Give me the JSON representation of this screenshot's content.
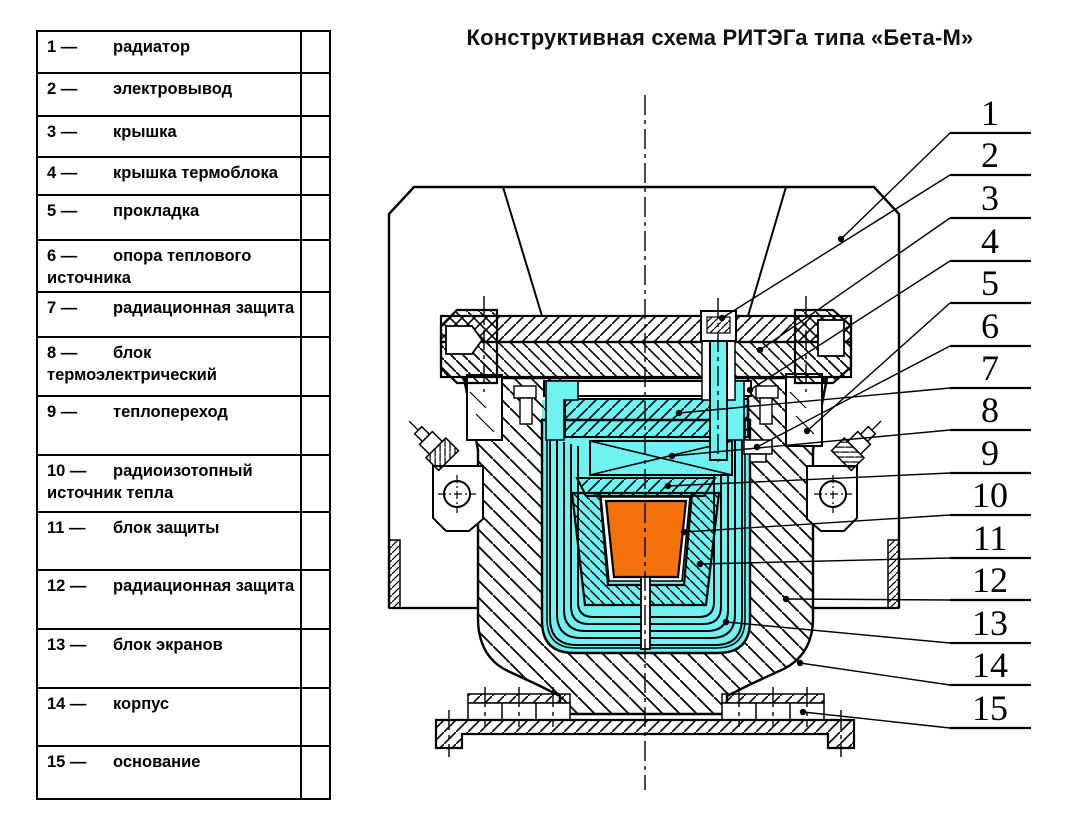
{
  "title": "Конструктивная схема РИТЭГа типа «Бета-М»",
  "legend": {
    "items": [
      {
        "num": "1",
        "name": "радиатор"
      },
      {
        "num": "2",
        "name": "электровывод"
      },
      {
        "num": "3",
        "name": "крышка"
      },
      {
        "num": "4",
        "name": "крышка термоблока"
      },
      {
        "num": "5",
        "name": "прокладка"
      },
      {
        "num": "6",
        "name": "опора теплового источника"
      },
      {
        "num": "7",
        "name": "радиационная защита"
      },
      {
        "num": "8",
        "name": "блок термоэлектрический"
      },
      {
        "num": "9",
        "name": "теплопереход"
      },
      {
        "num": "10",
        "name": "радиоизотопный источник тепла"
      },
      {
        "num": "11",
        "name": "блок защиты"
      },
      {
        "num": "12",
        "name": "радиационная защита"
      },
      {
        "num": "13",
        "name": "блок экранов"
      },
      {
        "num": "14",
        "name": "корпус"
      },
      {
        "num": "15",
        "name": "основание"
      }
    ]
  },
  "callouts": [
    {
      "num": "1",
      "uy": 133,
      "tx": 841,
      "ty": 239
    },
    {
      "num": "2",
      "uy": 175,
      "tx": 722,
      "ty": 318
    },
    {
      "num": "3",
      "uy": 218,
      "tx": 760,
      "ty": 350
    },
    {
      "num": "4",
      "uy": 261,
      "tx": 750,
      "ty": 390
    },
    {
      "num": "5",
      "uy": 303,
      "tx": 807,
      "ty": 431
    },
    {
      "num": "6",
      "uy": 346,
      "tx": 757,
      "ty": 447
    },
    {
      "num": "7",
      "uy": 388,
      "tx": 679,
      "ty": 413
    },
    {
      "num": "8",
      "uy": 430,
      "tx": 672,
      "ty": 456
    },
    {
      "num": "9",
      "uy": 473,
      "tx": 668,
      "ty": 486
    },
    {
      "num": "10",
      "uy": 515,
      "tx": 684,
      "ty": 532
    },
    {
      "num": "11",
      "uy": 558,
      "tx": 700,
      "ty": 564
    },
    {
      "num": "12",
      "uy": 600,
      "tx": 786,
      "ty": 599
    },
    {
      "num": "13",
      "uy": 643,
      "tx": 726,
      "ty": 622
    },
    {
      "num": "14",
      "uy": 685,
      "tx": 800,
      "ty": 663
    },
    {
      "num": "15",
      "uy": 728,
      "tx": 803,
      "ty": 712
    }
  ],
  "colors": {
    "cyan": "#6ff2f2",
    "orange": "#f4710b",
    "line": "#000000"
  }
}
